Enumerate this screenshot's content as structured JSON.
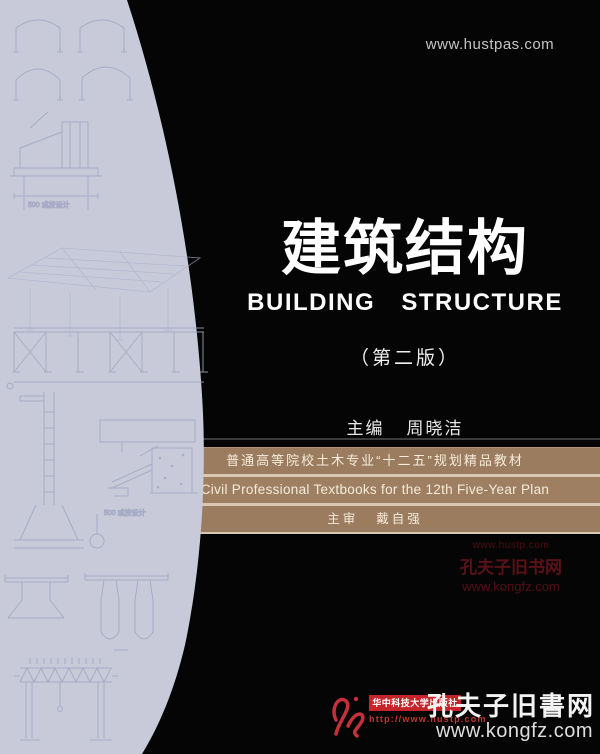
{
  "page": {
    "background": "#050505",
    "top_website": "www.hustpas.com"
  },
  "cover": {
    "title_zh": "建筑结构",
    "title_en": "BUILDING STRUCTURE",
    "edition": "（第二版）",
    "editor_role": "主编",
    "editor_name": "周晓洁"
  },
  "banner": {
    "bg_color": "#9c7c5e",
    "separator_color": "#d8c8b2",
    "line1": "普通高等院校土木专业“十二五”规划精品教材",
    "line2": "Civil Professional Textbooks for the 12th Five-Year Plan",
    "line3_role": "主审",
    "line3_name": "戴自强"
  },
  "watermark_mid": {
    "color": "#5a1118",
    "url_small": "www.hustp.com",
    "site_name": "孔夫子旧书网",
    "site_url": "www.kongfz.com"
  },
  "footer": {
    "publisher_red": "#c5242b",
    "publisher": "华中科技大学出版社",
    "publisher_url": "http://www.hustp.com",
    "kongfz_name": "孔夫子旧書网",
    "kongfz_url": "www.kongfz.com"
  },
  "left_panel": {
    "bg_color": "#c8cada",
    "line_color": "#a2a7c1",
    "annotation": "500 或按设计"
  }
}
